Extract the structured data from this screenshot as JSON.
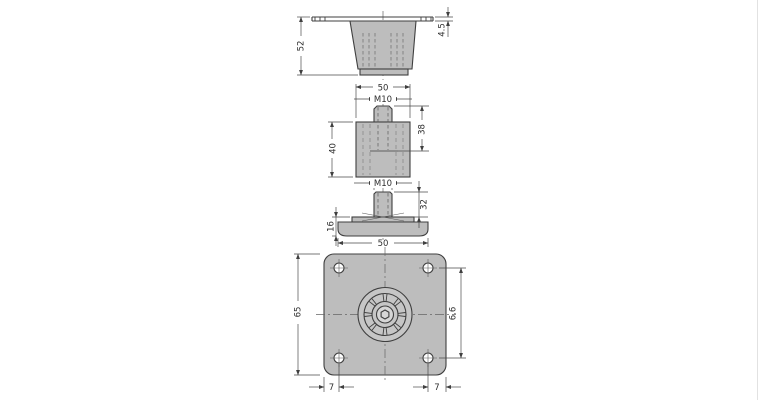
{
  "drawing": {
    "views": {
      "socket": {
        "height": "52",
        "flange_thickness": "4.5"
      },
      "buffer": {
        "diameter": "50",
        "thread": "M10",
        "stud_length": "38",
        "height": "40"
      },
      "leveler": {
        "thread": "M10",
        "stem_length": "32",
        "base_height": "16",
        "base_diameter": "50"
      },
      "plate": {
        "size": "65",
        "hole_dimension": "6.6",
        "edge_offset_left": "7",
        "edge_offset_right": "7"
      }
    },
    "colors": {
      "line": "#3f3f3f",
      "dim_line": "#4a4a4a",
      "fill": "#bdbdbd",
      "fill_light": "#c6c6c6",
      "centerline": "#666666",
      "background": "#ffffff",
      "page_edge": "#e2e2e2"
    }
  }
}
